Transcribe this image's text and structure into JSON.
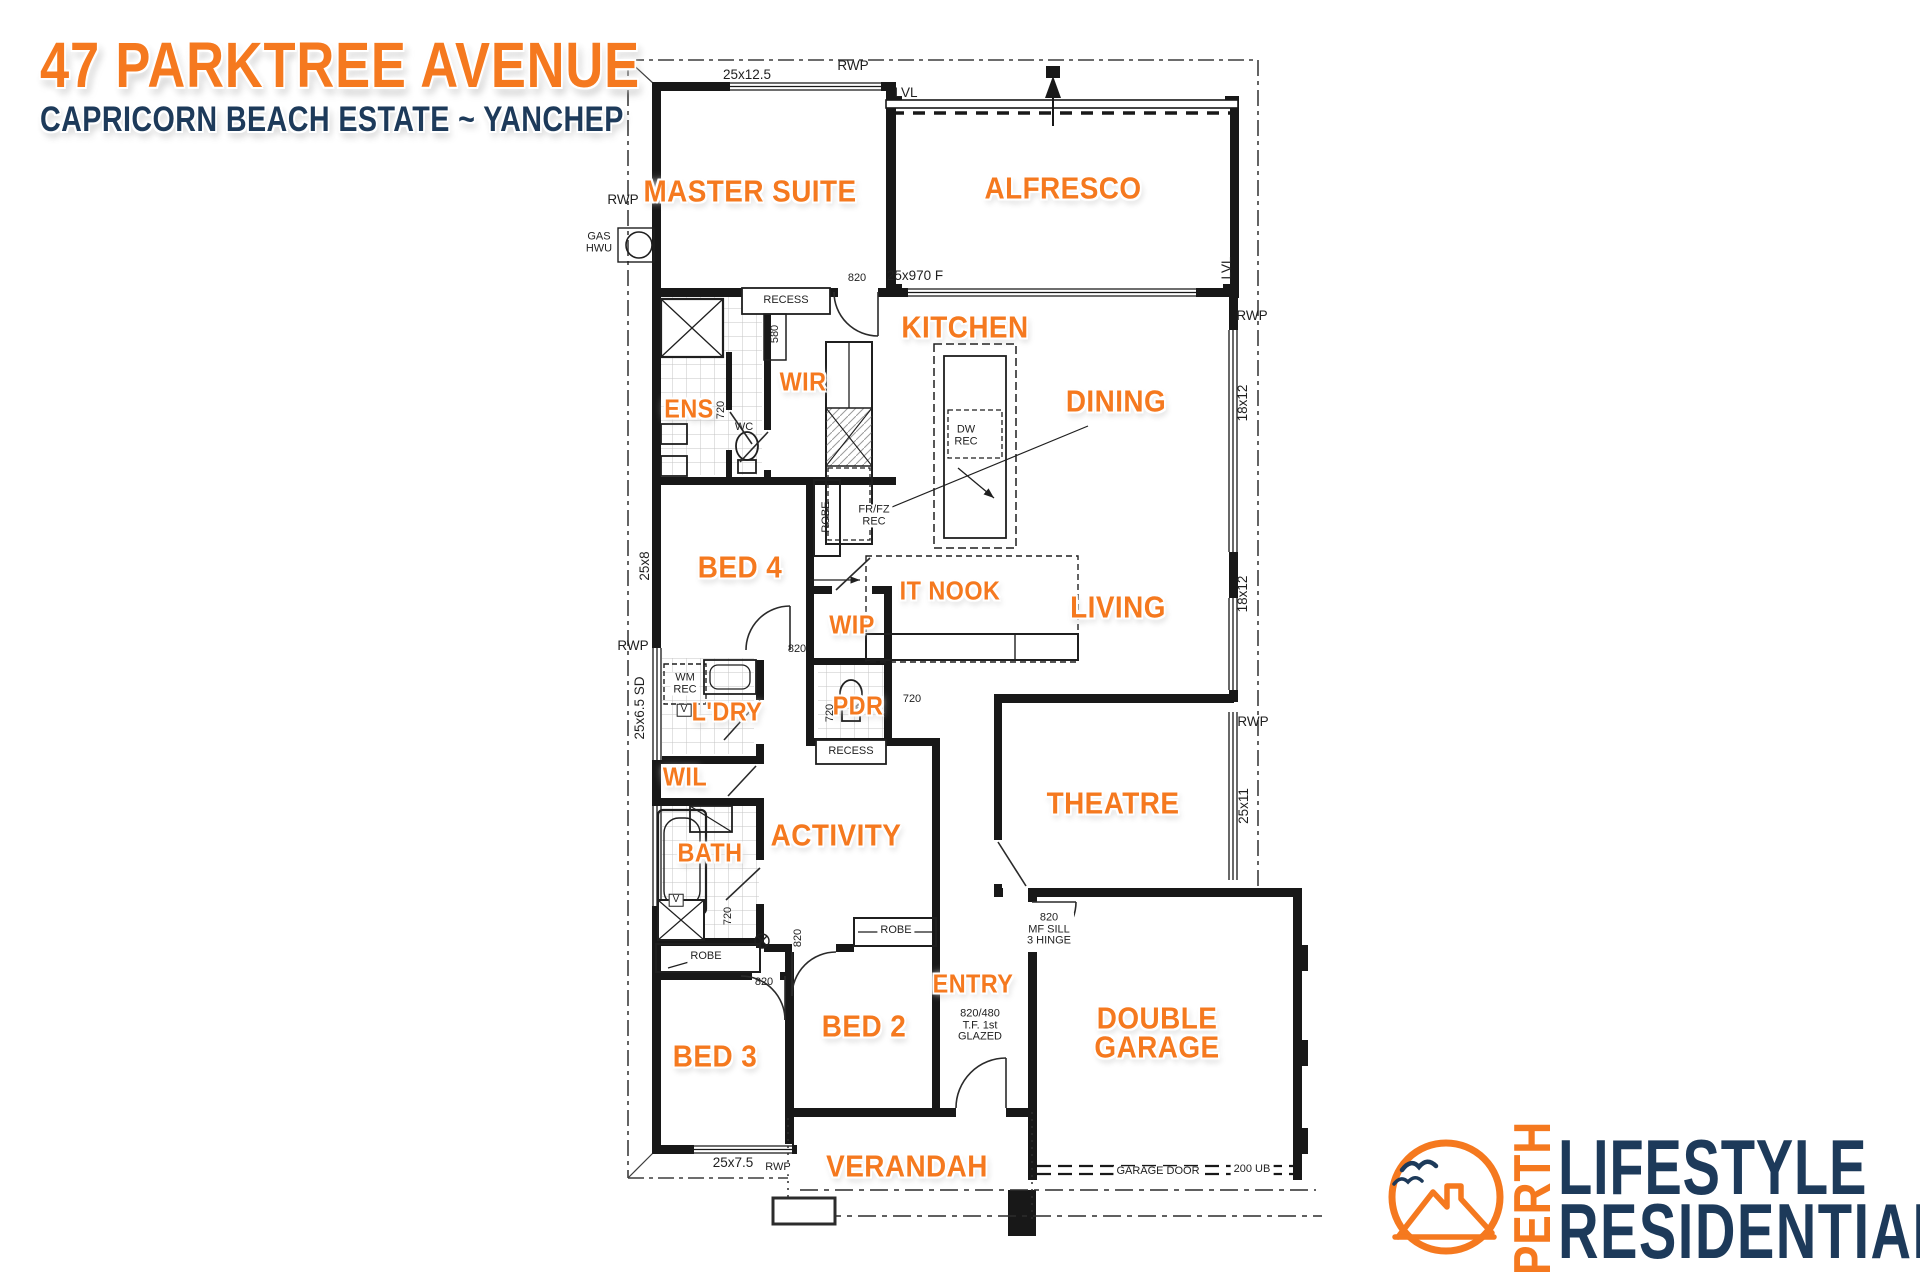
{
  "title": {
    "address": "47 PARKTREE AVENUE",
    "estate": "CAPRICORN BEACH ESTATE ~ YANCHEP"
  },
  "colors": {
    "orange": "#F5791F",
    "navy": "#1D3A5A",
    "ink": "#181818"
  },
  "logo": {
    "city": "PERTH",
    "line1": "LIFESTYLE",
    "line2": "RESIDENTIAL"
  },
  "floorplan": {
    "rooms": [
      {
        "id": "master-suite",
        "label": "MASTER SUITE",
        "x": 750,
        "y": 191,
        "size": "lg"
      },
      {
        "id": "alfresco",
        "label": "ALFRESCO",
        "x": 1063,
        "y": 188,
        "size": "lg"
      },
      {
        "id": "kitchen",
        "label": "KITCHEN",
        "x": 965,
        "y": 327,
        "size": "lg"
      },
      {
        "id": "ens",
        "label": "ENS",
        "x": 689,
        "y": 409,
        "size": "md"
      },
      {
        "id": "wir",
        "label": "WIR",
        "x": 803,
        "y": 382,
        "size": "md"
      },
      {
        "id": "dining",
        "label": "DINING",
        "x": 1116,
        "y": 401,
        "size": "lg"
      },
      {
        "id": "bed-4",
        "label": "BED 4",
        "x": 740,
        "y": 567,
        "size": "lg"
      },
      {
        "id": "it-nook",
        "label": "IT NOOK",
        "x": 950,
        "y": 591,
        "size": "md"
      },
      {
        "id": "wip",
        "label": "WIP",
        "x": 852,
        "y": 625,
        "size": "md"
      },
      {
        "id": "living",
        "label": "LIVING",
        "x": 1118,
        "y": 607,
        "size": "lg"
      },
      {
        "id": "ldry",
        "label": "L'DRY",
        "x": 727,
        "y": 712,
        "size": "md"
      },
      {
        "id": "pdr",
        "label": "PDR",
        "x": 858,
        "y": 706,
        "size": "md"
      },
      {
        "id": "wil",
        "label": "WIL",
        "x": 685,
        "y": 777,
        "size": "md"
      },
      {
        "id": "bath",
        "label": "BATH",
        "x": 710,
        "y": 853,
        "size": "md"
      },
      {
        "id": "activity",
        "label": "ACTIVITY",
        "x": 836,
        "y": 835,
        "size": "lg"
      },
      {
        "id": "theatre",
        "label": "THEATRE",
        "x": 1113,
        "y": 803,
        "size": "lg"
      },
      {
        "id": "entry",
        "label": "ENTRY",
        "x": 973,
        "y": 984,
        "size": "md"
      },
      {
        "id": "bed-3",
        "label": "BED 3",
        "x": 715,
        "y": 1056,
        "size": "lg"
      },
      {
        "id": "bed-2",
        "label": "BED 2",
        "x": 864,
        "y": 1026,
        "size": "lg"
      },
      {
        "id": "double-garage",
        "label": "DOUBLE\nGARAGE",
        "x": 1157,
        "y": 1033,
        "size": "lg"
      },
      {
        "id": "verandah",
        "label": "VERANDAH",
        "x": 907,
        "y": 1166,
        "size": "lg"
      }
    ],
    "annotations": [
      {
        "t": "RWP",
        "x": 623,
        "y": 200
      },
      {
        "t": "25x12.5",
        "x": 747,
        "y": 75
      },
      {
        "t": "RWP",
        "x": 853,
        "y": 66
      },
      {
        "t": "LVL",
        "x": 906,
        "y": 93
      },
      {
        "t": "GAS\nHWU",
        "x": 599,
        "y": 243,
        "cls": "sm"
      },
      {
        "t": "25x970 F",
        "x": 915,
        "y": 276
      },
      {
        "t": "820",
        "x": 857,
        "y": 279,
        "cls": "sm"
      },
      {
        "t": "RECESS",
        "x": 786,
        "y": 301,
        "cls": "sm bg"
      },
      {
        "t": "580",
        "x": 776,
        "y": 334,
        "rot": true,
        "cls": "sm"
      },
      {
        "t": "WC",
        "x": 744,
        "y": 428,
        "cls": "sm"
      },
      {
        "t": "720",
        "x": 722,
        "y": 410,
        "rot": true,
        "cls": "sm"
      },
      {
        "t": "LVL",
        "x": 1227,
        "y": 268,
        "rot": true
      },
      {
        "t": "RWP",
        "x": 1252,
        "y": 316
      },
      {
        "t": "18x12",
        "x": 1243,
        "y": 403,
        "rot": true
      },
      {
        "t": "DW\nREC",
        "x": 966,
        "y": 436,
        "cls": "sm bg"
      },
      {
        "t": "FR/FZ\nREC",
        "x": 874,
        "y": 516,
        "cls": "sm bg"
      },
      {
        "t": "ROBE",
        "x": 827,
        "y": 517,
        "rot": true,
        "cls": "sm"
      },
      {
        "t": "25x8",
        "x": 645,
        "y": 566,
        "rot": true
      },
      {
        "t": "820",
        "x": 797,
        "y": 650,
        "cls": "sm"
      },
      {
        "t": "RWP",
        "x": 633,
        "y": 646
      },
      {
        "t": "25x6.5 SD",
        "x": 640,
        "y": 708,
        "rot": true
      },
      {
        "t": "WM\nREC",
        "x": 685,
        "y": 684,
        "cls": "sm bg"
      },
      {
        "t": "18x12",
        "x": 1243,
        "y": 594,
        "rot": true
      },
      {
        "t": "RWP",
        "x": 1253,
        "y": 722
      },
      {
        "t": "25x11",
        "x": 1244,
        "y": 806,
        "rot": true
      },
      {
        "t": "720",
        "x": 831,
        "y": 713,
        "rot": true,
        "cls": "sm"
      },
      {
        "t": "720",
        "x": 912,
        "y": 700,
        "cls": "sm"
      },
      {
        "t": "RECESS",
        "x": 851,
        "y": 752,
        "cls": "sm bg"
      },
      {
        "t": "720",
        "x": 729,
        "y": 916,
        "rot": true,
        "cls": "sm"
      },
      {
        "t": "ROBE",
        "x": 706,
        "y": 957,
        "cls": "sm bg"
      },
      {
        "t": "820",
        "x": 799,
        "y": 938,
        "rot": true,
        "cls": "sm"
      },
      {
        "t": "820",
        "x": 764,
        "y": 983,
        "cls": "sm"
      },
      {
        "t": "ROBE",
        "x": 896,
        "y": 931,
        "cls": "sm bg"
      },
      {
        "t": "820\nMF SILL\n3 HINGE",
        "x": 1049,
        "y": 930,
        "cls": "sm bg"
      },
      {
        "t": "820/480\nT.F. 1st\nGLAZED",
        "x": 980,
        "y": 1026,
        "cls": "sm"
      },
      {
        "t": "25x7.5",
        "x": 733,
        "y": 1163
      },
      {
        "t": "RWP",
        "x": 778,
        "y": 1168,
        "cls": "sm bg"
      },
      {
        "t": "GARAGE DOOR",
        "x": 1158,
        "y": 1172,
        "cls": "sm bg"
      },
      {
        "t": "200 UB",
        "x": 1252,
        "y": 1170,
        "cls": "sm bg"
      },
      {
        "t": "V",
        "x": 684,
        "y": 710,
        "cls": "vbox"
      },
      {
        "t": "V",
        "x": 676,
        "y": 900,
        "cls": "vbox"
      }
    ]
  }
}
